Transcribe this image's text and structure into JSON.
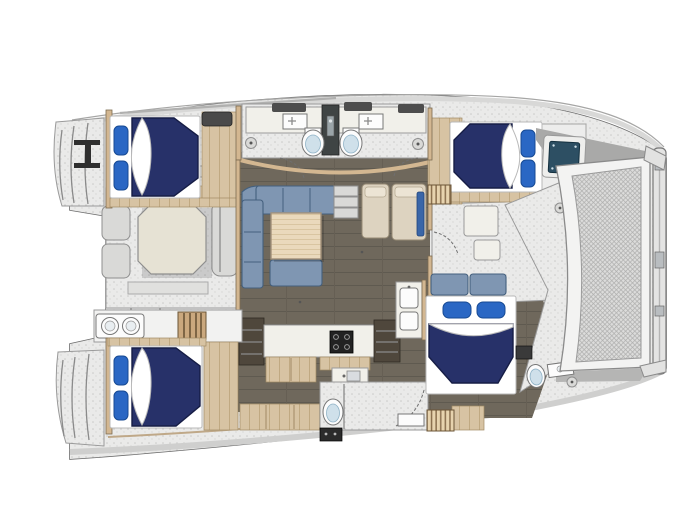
{
  "diagram": {
    "title": "catamaran-interior-floor-plan",
    "type": "yacht-floor-plan",
    "orientation": {
      "bow": "right",
      "stern": "left"
    },
    "colors": {
      "page_bg": "#ffffff",
      "hull_outline": "#6b6b6b",
      "deck": "#eaeae9",
      "interior_floor": "#6f685c",
      "floor_line": "#5f5a50",
      "wood": "#d7c3a3",
      "wood_line": "#c0a982",
      "wall": "#d3b791",
      "wall_edge": "#7c6b50",
      "bed_navy": "#273169",
      "bed_navy_edge": "#161d45",
      "pillow_blue": "#2a67c4",
      "pillow_edge": "#174a93",
      "sofa": "#7f96b2",
      "sofa_edge": "#44607e",
      "table_wood": "#ead9bc",
      "cockpit_table": "#e6e2d4",
      "seat_gray": "#d9d9d7",
      "counter": "#f1f0ea",
      "appliance_dark": "#222222",
      "cabinet_dark": "#4f473c",
      "porcelain": "#fcfcfc",
      "toilet_seat": "#cfe0ea",
      "hatch_teal": "#2d4f63",
      "mesh_line": "#adadac",
      "mesh_bg": "#dcdcdb",
      "slat": "#e7d3ae",
      "slat_line": "#8a6f4e",
      "accent_blue": "#3a66a8",
      "partition": "#3f4444"
    },
    "elements": {
      "cabins": [
        {
          "id": "port-aft-cabin",
          "bed": "double-bed",
          "pillows": 2
        },
        {
          "id": "port-forward-cabin",
          "bed": "double-bed",
          "pillows": 2
        },
        {
          "id": "starboard-aft-cabin",
          "bed": "double-bed",
          "pillows": 2
        },
        {
          "id": "starboard-forward-cabin",
          "bed": "double-bed",
          "pillows": 2
        }
      ],
      "heads": [
        {
          "id": "port-heads",
          "toilets": 2,
          "sinks": 2
        },
        {
          "id": "starboard-aft-head",
          "toilets": 1,
          "shower": true
        },
        {
          "id": "starboard-forward-head",
          "toilets": 1,
          "sinks": 1
        }
      ],
      "salon": {
        "settee": "U-shaped",
        "table": "square",
        "companionway_steps": 3
      },
      "galley": {
        "stove_burners": 4,
        "sink": true
      },
      "aft_cockpit": {
        "table": "octagonal",
        "seats": true
      },
      "foredeck": {
        "trampoline": true,
        "crossbeam": true
      },
      "stern": {
        "transom_steps": 2,
        "davit_lines": 2
      }
    }
  }
}
